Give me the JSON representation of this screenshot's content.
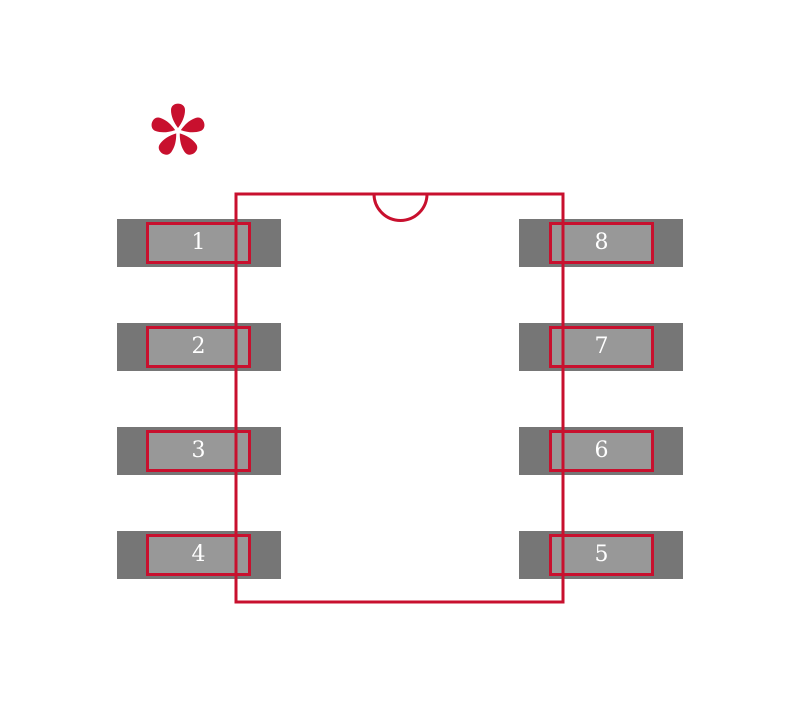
{
  "canvas": {
    "width": 800,
    "height": 707
  },
  "colors": {
    "outline": "#c8102e",
    "pad_outer": "#767676",
    "pad_inner": "#989898",
    "pad_label": "#ffffff",
    "background": "#ffffff"
  },
  "marker": {
    "glyph": "*"
  },
  "pads": [
    {
      "label": "1",
      "column": "left",
      "row": 1
    },
    {
      "label": "2",
      "column": "left",
      "row": 2
    },
    {
      "label": "3",
      "column": "left",
      "row": 3
    },
    {
      "label": "4",
      "column": "left",
      "row": 4
    },
    {
      "label": "8",
      "column": "right",
      "row": 1
    },
    {
      "label": "7",
      "column": "right",
      "row": 2
    },
    {
      "label": "6",
      "column": "right",
      "row": 3
    },
    {
      "label": "5",
      "column": "right",
      "row": 4
    }
  ]
}
